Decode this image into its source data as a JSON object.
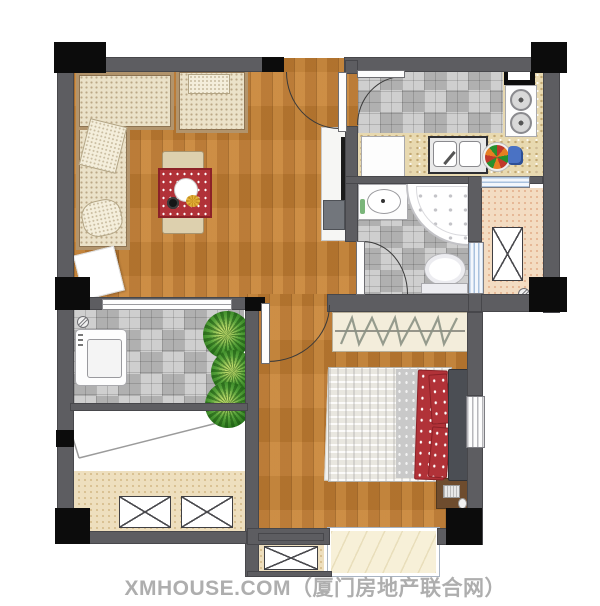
{
  "watermark": {
    "text": "XMHOUSE.COM（厦门房地产联合网）"
  },
  "palette": {
    "wall": "#5d5d61",
    "column": "#0c0c0c",
    "wood": "#c57f33",
    "tile": "#cbcbcb",
    "granite": "#e8d9b0",
    "balcony_pink": "#f3dcc2",
    "balcony_beige": "#eedfbe",
    "marble": "#f7f0d8",
    "sofa_fabric": "#ebe2c9",
    "accent_red": "#b13238",
    "plant_green": "#2c7a1e",
    "watermark": "#a3a3a3"
  },
  "icon_names": [
    "entry-door-icon",
    "kitchen-door-icon",
    "bathroom-door-icon",
    "bedroom-door-icon",
    "l-sofa-icon",
    "armchair-icon",
    "dining-table-icon",
    "tv-cabinet-icon",
    "refrigerator-icon",
    "kitchen-sink-icon",
    "gas-stove-icon",
    "range-hood-icon",
    "fruit-plate-icon",
    "bathroom-vanity-icon",
    "corner-bathtub-icon",
    "toilet-icon",
    "washing-machine-icon",
    "plant-icon",
    "wardrobe-hangers-icon",
    "double-bed-icon",
    "desk-computer-icon",
    "ac-unit-icon",
    "floor-drain-icon",
    "window-icon"
  ]
}
